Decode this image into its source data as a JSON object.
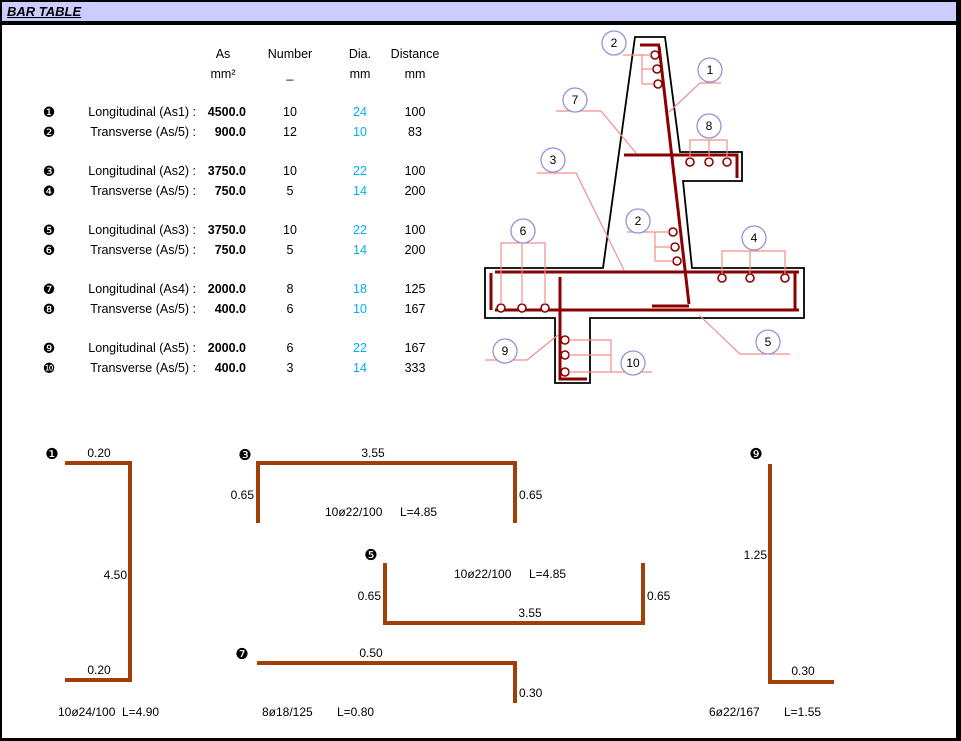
{
  "title": "BAR TABLE",
  "table": {
    "headers": {
      "as": "As",
      "number": "Number",
      "dia": "Dia.",
      "distance": "Distance"
    },
    "units": {
      "as": "mm²",
      "number": "_",
      "dia": "mm",
      "distance": "mm"
    },
    "rows": [
      {
        "bullet": "❶",
        "label": "Longitudinal (As1) :",
        "as": "4500.0",
        "number": "10",
        "dia": "24",
        "distance": "100"
      },
      {
        "bullet": "❷",
        "label": "Transverse (As/5) :",
        "as": "900.0",
        "number": "12",
        "dia": "10",
        "distance": "83"
      },
      {
        "bullet": "❸",
        "label": "Longitudinal (As2) :",
        "as": "3750.0",
        "number": "10",
        "dia": "22",
        "distance": "100"
      },
      {
        "bullet": "❹",
        "label": "Transverse (As/5) :",
        "as": "750.0",
        "number": "5",
        "dia": "14",
        "distance": "200"
      },
      {
        "bullet": "❺",
        "label": "Longitudinal (As3) :",
        "as": "3750.0",
        "number": "10",
        "dia": "22",
        "distance": "100"
      },
      {
        "bullet": "❻",
        "label": "Transverse (As/5) :",
        "as": "750.0",
        "number": "5",
        "dia": "14",
        "distance": "200"
      },
      {
        "bullet": "❼",
        "label": "Longitudinal (As4) :",
        "as": "2000.0",
        "number": "8",
        "dia": "18",
        "distance": "125"
      },
      {
        "bullet": "❽",
        "label": "Transverse (As/5) :",
        "as": "400.0",
        "number": "6",
        "dia": "10",
        "distance": "167"
      },
      {
        "bullet": "❾",
        "label": "Longitudinal (As5) :",
        "as": "2000.0",
        "number": "6",
        "dia": "22",
        "distance": "167"
      },
      {
        "bullet": "❿",
        "label": "Transverse (As/5) :",
        "as": "400.0",
        "number": "3",
        "dia": "14",
        "distance": "333"
      }
    ]
  },
  "drawing": {
    "callouts": [
      "2",
      "1",
      "7",
      "8",
      "3",
      "2",
      "6",
      "4",
      "9",
      "10",
      "5"
    ]
  },
  "shapes": [
    {
      "bullet": "❶",
      "dims": {
        "top": "0.20",
        "side": "4.50",
        "bottom": "0.20"
      },
      "spec": "10ø24/100",
      "length": "L=4.90"
    },
    {
      "bullet": "❸",
      "dims": {
        "top": "3.55",
        "left": "0.65",
        "right": "0.65"
      },
      "spec": "10ø22/100",
      "length": "L=4.85"
    },
    {
      "bullet": "❺",
      "dims": {
        "left": "0.65",
        "right": "0.65",
        "bottom": "3.55"
      },
      "spec": "10ø22/100",
      "length": "L=4.85"
    },
    {
      "bullet": "❼",
      "dims": {
        "top": "0.50",
        "right": "0.30"
      },
      "spec": "8ø18/125",
      "length": "L=0.80"
    },
    {
      "bullet": "❾",
      "dims": {
        "side": "1.25",
        "bottom": "0.30"
      },
      "spec": "6ø22/167",
      "length": "L=1.55"
    }
  ],
  "colors": {
    "title_bg": "#CCCCFF",
    "dia_text": "#00B0F0",
    "outline": "#000000",
    "rebar": "#8B0000",
    "leader": "#F58C8C",
    "callout_stroke": "#9494D6",
    "shape_bar": "#A04008"
  }
}
